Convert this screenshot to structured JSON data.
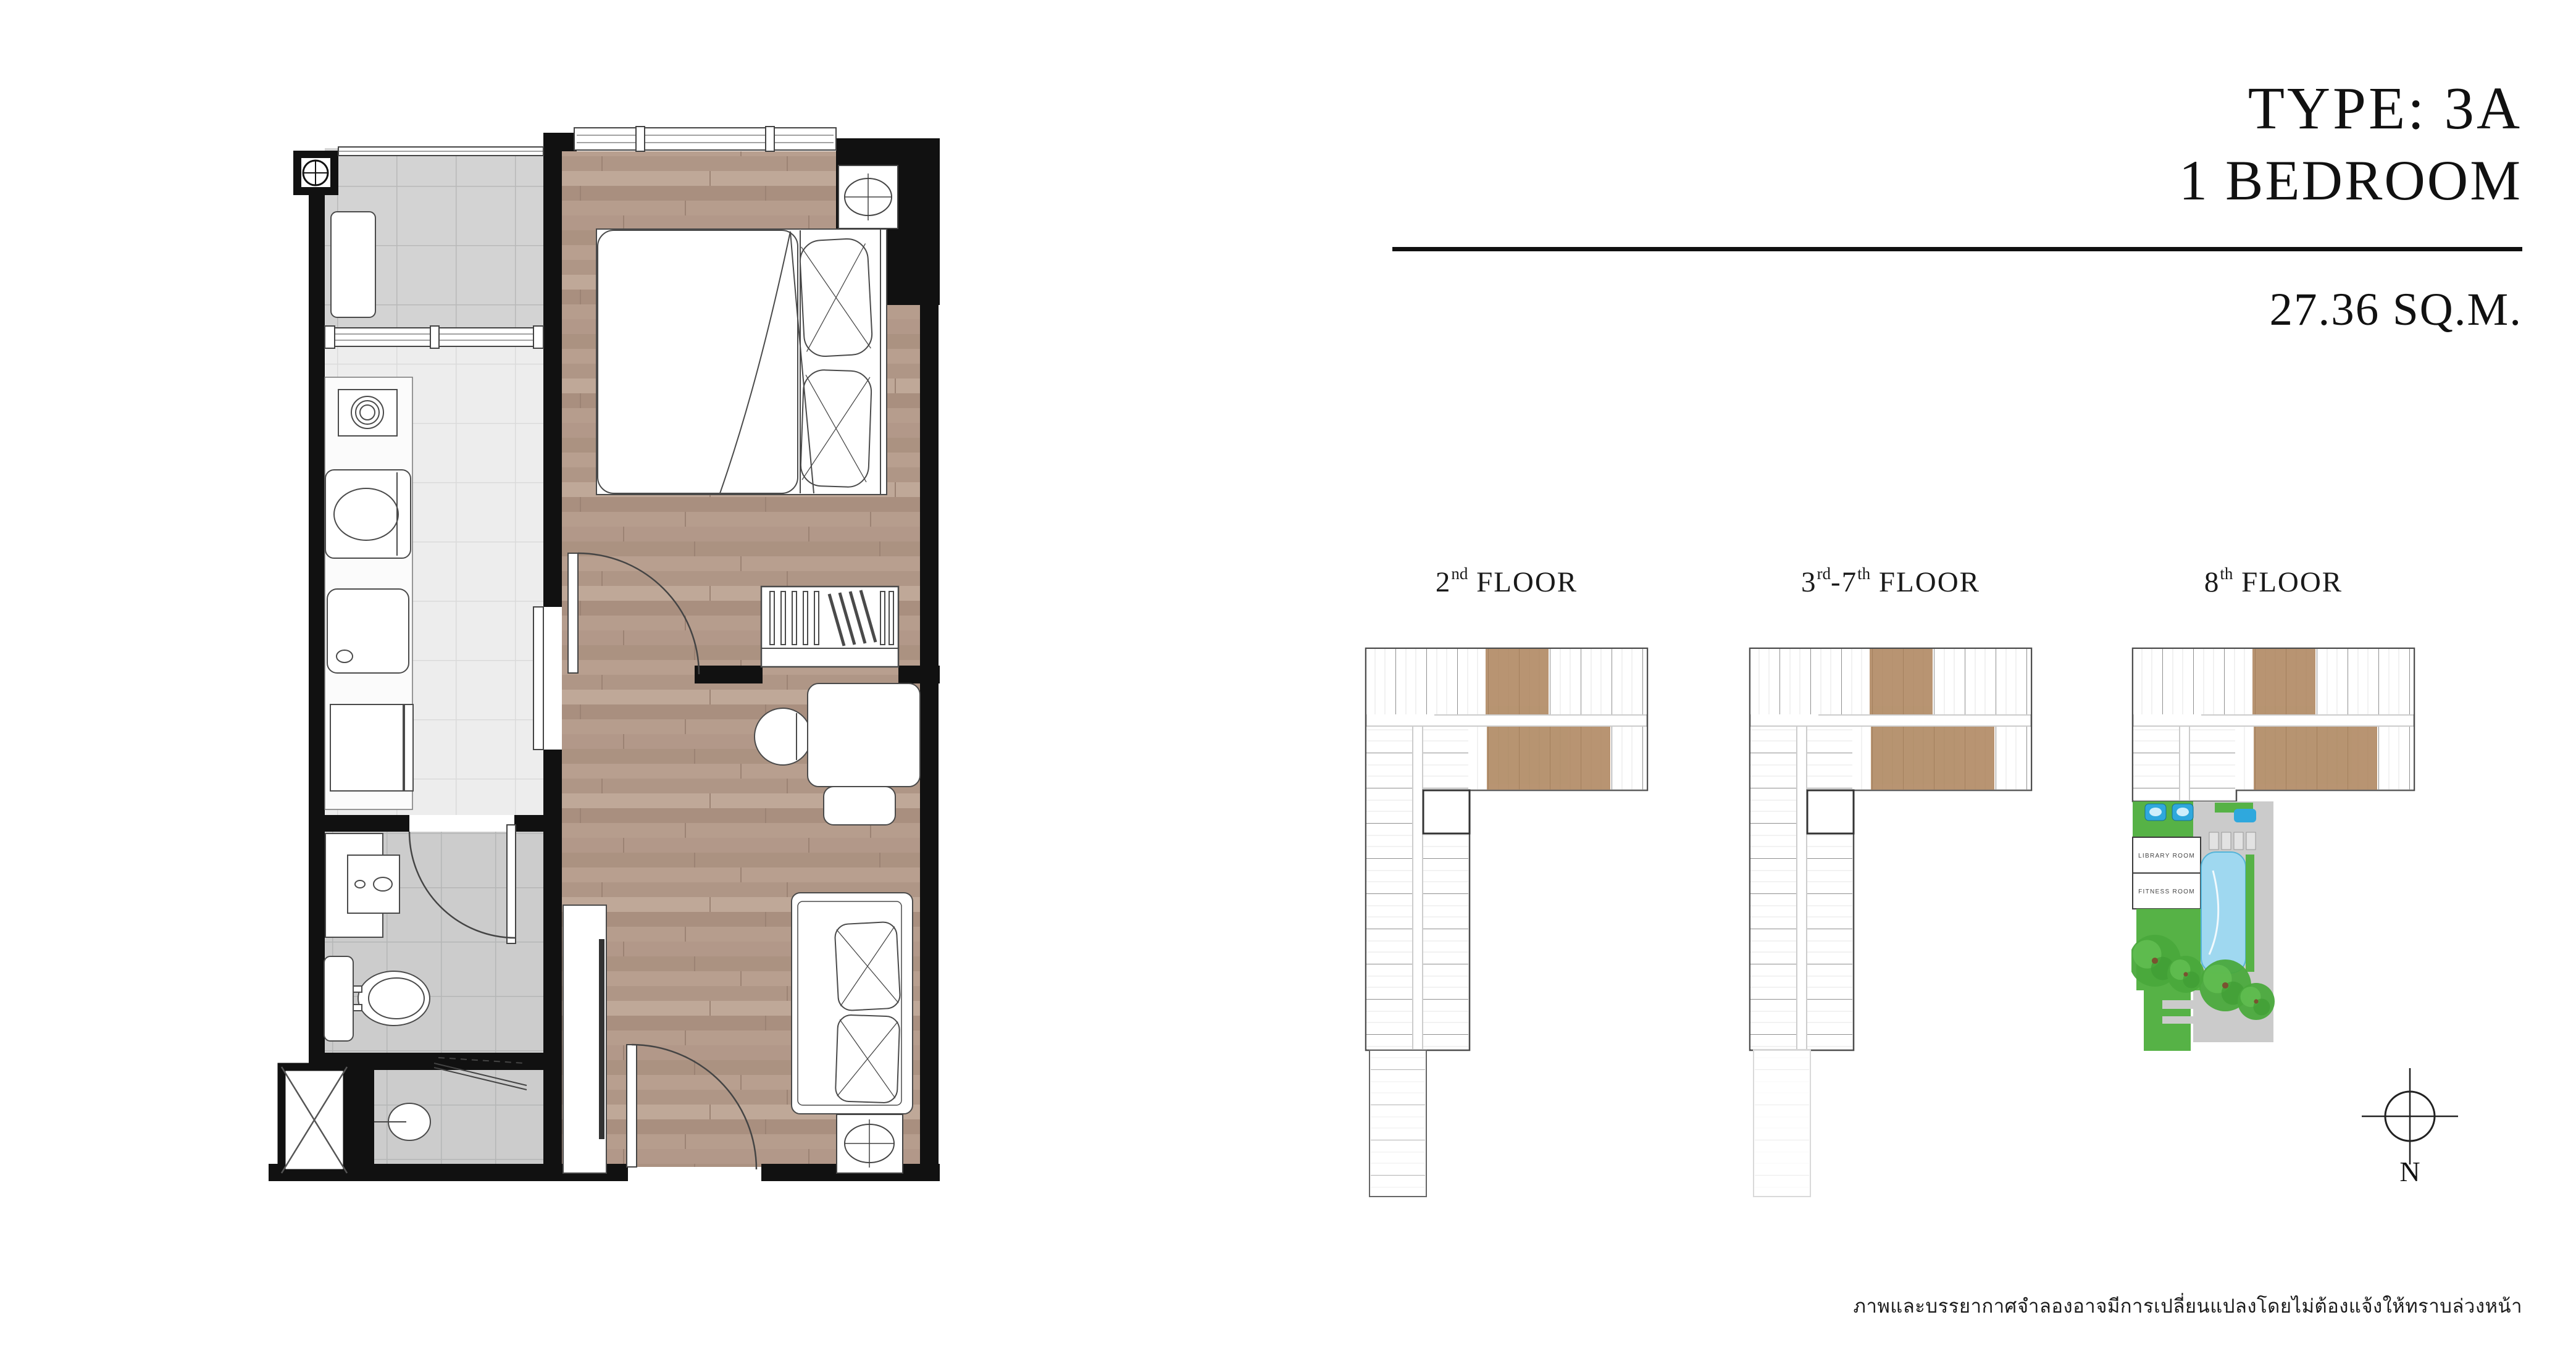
{
  "header": {
    "type_label": "TYPE: 3A",
    "bedroom_label": "1 BEDROOM",
    "area_label": "27.36 SQ.M."
  },
  "floor_labels": [
    {
      "name": "2nd FLOOR",
      "segments": [
        {
          "text": "2"
        },
        {
          "text": "nd",
          "sup": true
        },
        {
          "text": " FLOOR"
        }
      ]
    },
    {
      "name": "3rd-7th FLOOR",
      "segments": [
        {
          "text": "3"
        },
        {
          "text": "rd",
          "sup": true
        },
        {
          "text": "-7"
        },
        {
          "text": "th",
          "sup": true
        },
        {
          "text": " FLOOR"
        }
      ]
    },
    {
      "name": "8th FLOOR",
      "segments": [
        {
          "text": "8"
        },
        {
          "text": "th",
          "sup": true
        },
        {
          "text": " FLOOR"
        }
      ]
    }
  ],
  "amenity_labels": {
    "library": "LIBRARY ROOM",
    "fitness": "FITNESS ROOM"
  },
  "compass": {
    "north_label": "N"
  },
  "disclaimer": "ภาพและบรรยากาศจำลองอาจมีการเปลี่ยนแปลงโดยไม่ต้องแจ้งให้ทราบล่วงหน้า",
  "colors": {
    "highlight": "#a87d53",
    "wall": "#111111",
    "wood": "#b49c8c",
    "tilebalcony": "#d3d3d3",
    "tilekitchen": "#ededed",
    "tilebath": "#cccccc",
    "pool": "#9fd8f0",
    "pooltub": "#2fa8dd",
    "lawn": "#56b246",
    "tree": "#4aa93c",
    "deck": "#cbcbcb"
  }
}
